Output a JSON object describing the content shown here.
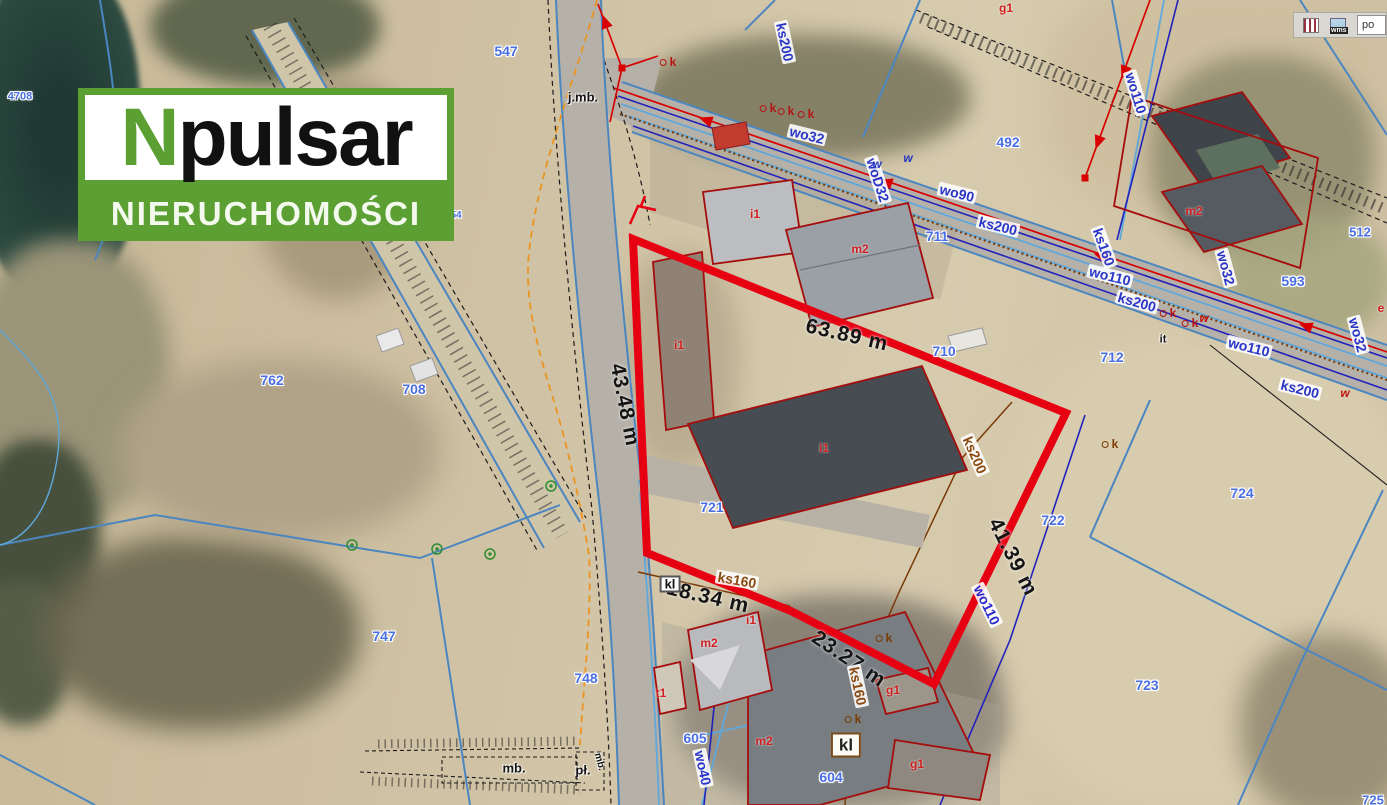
{
  "colors": {
    "logo_green": "#5ca033",
    "boundary_red": "#e60012",
    "parcel_blue": "#4a6fe3",
    "utility_blue": "#2a35c8",
    "utility_brown": "#8a4a0f",
    "building_red": "#cf1f1f",
    "power_red": "#d80000"
  },
  "logo": {
    "brand_first_letter": "N",
    "brand_rest": "pulsar",
    "subtitle": "NIERUCHOMOŚCI"
  },
  "toolbar": {
    "wms_label": "wms",
    "partial_button_label": "po"
  },
  "map": {
    "label_groups": [
      {
        "name": "dimension-label",
        "style": "dim",
        "items": [
          {
            "t": "63.89 m",
            "x": 847,
            "y": 335,
            "r": 13
          },
          {
            "t": "43.48 m",
            "x": 625,
            "y": 405,
            "r": 79
          },
          {
            "t": "41.39 m",
            "x": 1013,
            "y": 557,
            "r": 63
          },
          {
            "t": "18.34 m",
            "x": 708,
            "y": 597,
            "r": 13
          },
          {
            "t": "23.27 m",
            "x": 849,
            "y": 659,
            "r": 34
          }
        ]
      },
      {
        "name": "parcel-number",
        "style": "parcel",
        "items": [
          {
            "t": "4708",
            "x": 20,
            "y": 97,
            "f": 11
          },
          {
            "t": "547",
            "x": 506,
            "y": 51
          },
          {
            "t": "54",
            "x": 456,
            "y": 216,
            "f": 10
          },
          {
            "t": "492",
            "x": 1008,
            "y": 142
          },
          {
            "t": "711",
            "x": 937,
            "y": 236
          },
          {
            "t": "710",
            "x": 944,
            "y": 351
          },
          {
            "t": "712",
            "x": 1112,
            "y": 357
          },
          {
            "t": "593",
            "x": 1293,
            "y": 281
          },
          {
            "t": "512",
            "x": 1360,
            "y": 232,
            "f": 13
          },
          {
            "t": "722",
            "x": 1053,
            "y": 520
          },
          {
            "t": "721",
            "x": 712,
            "y": 507
          },
          {
            "t": "724",
            "x": 1242,
            "y": 493
          },
          {
            "t": "723",
            "x": 1147,
            "y": 685
          },
          {
            "t": "725",
            "x": 1373,
            "y": 800,
            "f": 13
          },
          {
            "t": "762",
            "x": 272,
            "y": 380
          },
          {
            "t": "708",
            "x": 414,
            "y": 389
          },
          {
            "t": "747",
            "x": 384,
            "y": 636
          },
          {
            "t": "748",
            "x": 586,
            "y": 678
          },
          {
            "t": "605",
            "x": 695,
            "y": 738
          },
          {
            "t": "604",
            "x": 831,
            "y": 777
          }
        ]
      },
      {
        "name": "utility-label-blue",
        "style": "ub",
        "items": [
          {
            "t": "ks200",
            "x": 785,
            "y": 42,
            "r": 78
          },
          {
            "t": "wo32",
            "x": 807,
            "y": 135,
            "r": 14
          },
          {
            "t": "woD32",
            "x": 878,
            "y": 180,
            "r": 72
          },
          {
            "t": "wo90",
            "x": 957,
            "y": 193,
            "r": 14
          },
          {
            "t": "ks200",
            "x": 998,
            "y": 226,
            "r": 14
          },
          {
            "t": "wo110",
            "x": 1136,
            "y": 93,
            "r": 73
          },
          {
            "t": "wo110",
            "x": 1110,
            "y": 276,
            "r": 14
          },
          {
            "t": "ks200",
            "x": 1137,
            "y": 302,
            "r": 16
          },
          {
            "t": "wo110",
            "x": 1249,
            "y": 347,
            "r": 14
          },
          {
            "t": "ks200",
            "x": 1300,
            "y": 389,
            "r": 14
          },
          {
            "t": "wo32",
            "x": 1226,
            "y": 268,
            "r": 75
          },
          {
            "t": "wo32",
            "x": 1358,
            "y": 335,
            "r": 75
          },
          {
            "t": "ks160",
            "x": 1104,
            "y": 247,
            "r": 70
          },
          {
            "t": "wo40",
            "x": 703,
            "y": 768,
            "r": 78
          }
        ]
      },
      {
        "name": "utility-label-brown",
        "style": "ubr",
        "items": [
          {
            "t": "ks200",
            "x": 975,
            "y": 455,
            "r": 66
          },
          {
            "t": "ks160",
            "x": 737,
            "y": 580,
            "r": 10
          },
          {
            "t": "ks160",
            "x": 858,
            "y": 686,
            "r": 78
          }
        ]
      },
      {
        "name": "utility-label-navy",
        "style": "un",
        "items": [
          {
            "t": "wo110",
            "x": 987,
            "y": 605,
            "r": 64
          }
        ]
      },
      {
        "name": "building-label",
        "style": "bld",
        "items": [
          {
            "t": "i1",
            "x": 755,
            "y": 214
          },
          {
            "t": "m2",
            "x": 860,
            "y": 249
          },
          {
            "t": "i1",
            "x": 679,
            "y": 345
          },
          {
            "t": "i1",
            "x": 824,
            "y": 448
          },
          {
            "t": "m2",
            "x": 1194,
            "y": 211
          },
          {
            "t": "g1",
            "x": 1006,
            "y": 8
          },
          {
            "t": "i1",
            "x": 751,
            "y": 620
          },
          {
            "t": "m2",
            "x": 709,
            "y": 643
          },
          {
            "t": "m2",
            "x": 764,
            "y": 741
          },
          {
            "t": "t1",
            "x": 661,
            "y": 693
          },
          {
            "t": "g1",
            "x": 893,
            "y": 690
          },
          {
            "t": "g1",
            "x": 917,
            "y": 764
          },
          {
            "t": "e",
            "x": 1381,
            "y": 308
          }
        ]
      },
      {
        "name": "text-annotation",
        "style": "blk",
        "items": [
          {
            "t": "j.mb.",
            "x": 583,
            "y": 97
          },
          {
            "t": "mb.",
            "x": 514,
            "y": 768
          },
          {
            "t": "pł.",
            "x": 583,
            "y": 770
          },
          {
            "t": "mb.",
            "x": 599,
            "y": 762,
            "r": 75,
            "f": 10
          },
          {
            "t": "it",
            "x": 1163,
            "y": 340,
            "f": 11
          }
        ]
      },
      {
        "name": "kl-label",
        "style": "box",
        "items": [
          {
            "t": "kl",
            "x": 670,
            "y": 584
          }
        ]
      },
      {
        "name": "kl-label-large",
        "style": "boxbig",
        "items": [
          {
            "t": "kl",
            "x": 846,
            "y": 745
          }
        ]
      },
      {
        "name": "k-point-label",
        "style": "kpt kr",
        "items": [
          {
            "t": "k",
            "x": 668,
            "y": 62
          },
          {
            "t": "k",
            "x": 768,
            "y": 108
          },
          {
            "t": "k",
            "x": 786,
            "y": 111
          },
          {
            "t": "k",
            "x": 806,
            "y": 114
          },
          {
            "t": "k",
            "x": 1168,
            "y": 313
          },
          {
            "t": "k",
            "x": 1190,
            "y": 323
          }
        ]
      },
      {
        "name": "k-point-label-brown",
        "style": "kpt kbr",
        "items": [
          {
            "t": "k",
            "x": 884,
            "y": 638
          },
          {
            "t": "k",
            "x": 853,
            "y": 719
          },
          {
            "t": "k",
            "x": 1110,
            "y": 444
          }
        ]
      },
      {
        "name": "w-point-label",
        "style": "wpt wn",
        "items": [
          {
            "t": "w",
            "x": 877,
            "y": 164
          },
          {
            "t": "w",
            "x": 908,
            "y": 158
          }
        ]
      },
      {
        "name": "w-point-label-red",
        "style": "wpt wr",
        "items": [
          {
            "t": "w",
            "x": 1204,
            "y": 318
          },
          {
            "t": "w",
            "x": 1345,
            "y": 393
          }
        ]
      }
    ]
  }
}
